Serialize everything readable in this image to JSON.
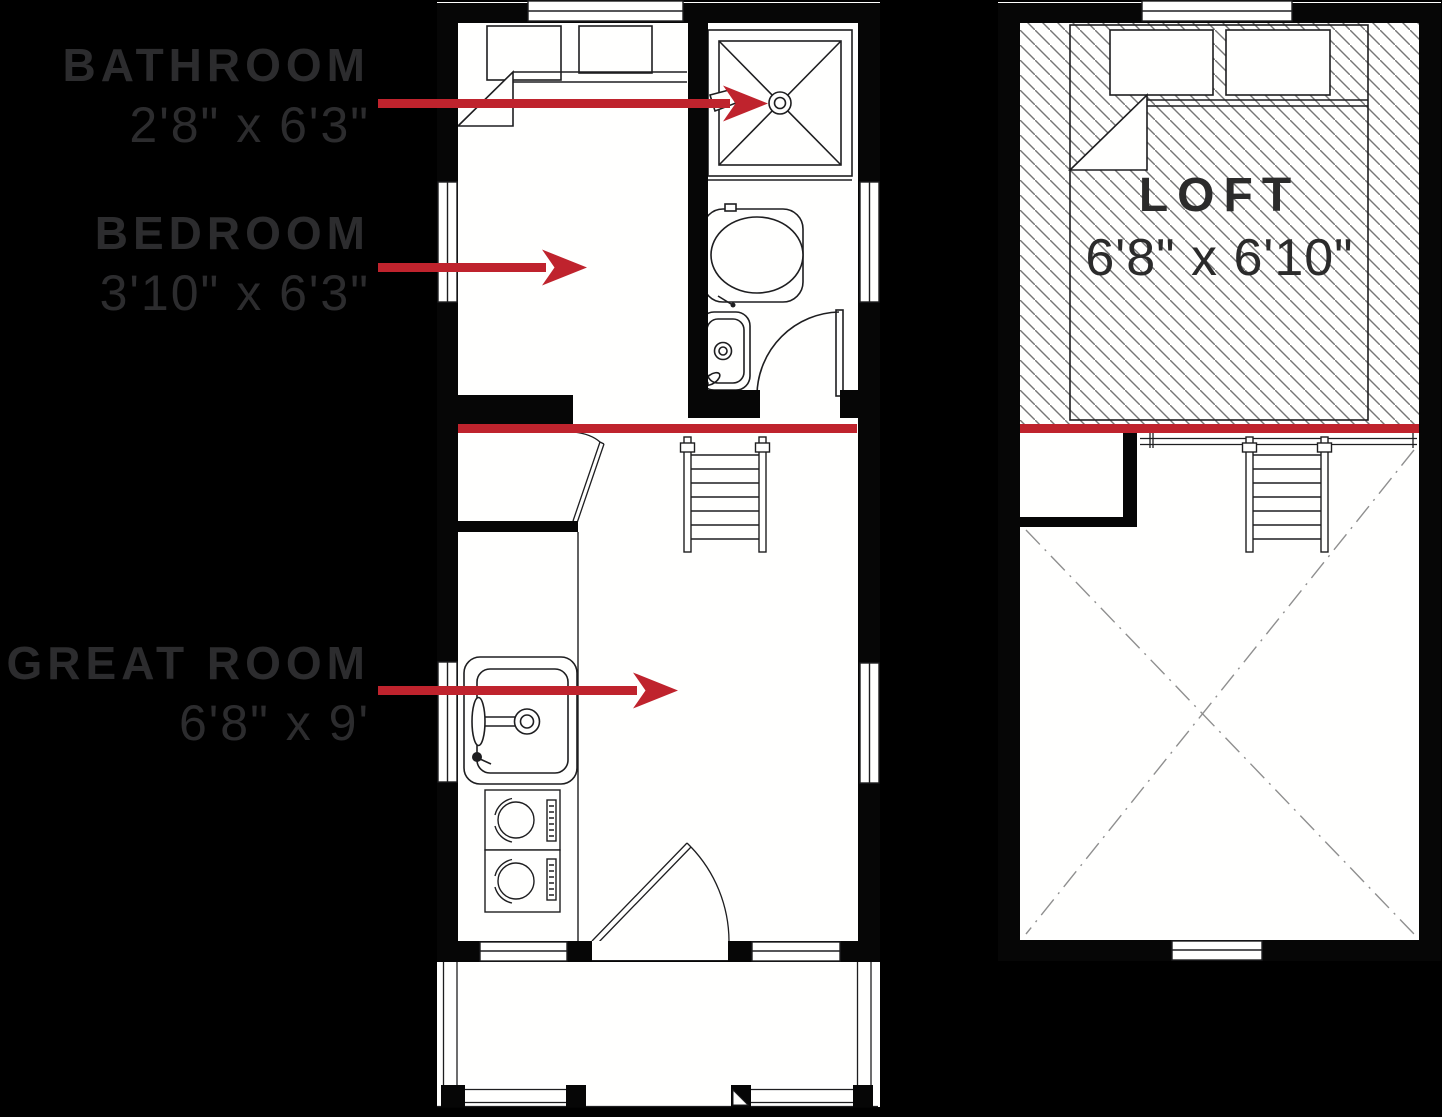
{
  "colors": {
    "background": "#000000",
    "accent_red": "#bf232d",
    "label_text": "#2c2c2e",
    "loft_text": "#2b2b2b",
    "plan_line": "#1e1e20"
  },
  "annotations": {
    "bathroom": {
      "label": "BATHROOM",
      "dims": "2'8\" x 6'3\""
    },
    "bedroom": {
      "label": "BEDROOM",
      "dims": "3'10\" x 6'3\""
    },
    "great_room": {
      "label": "GREAT ROOM",
      "dims": "6'8\" x 9'"
    },
    "loft": {
      "label": "LOFT",
      "dims": "6'8\" x 6'10\""
    }
  }
}
